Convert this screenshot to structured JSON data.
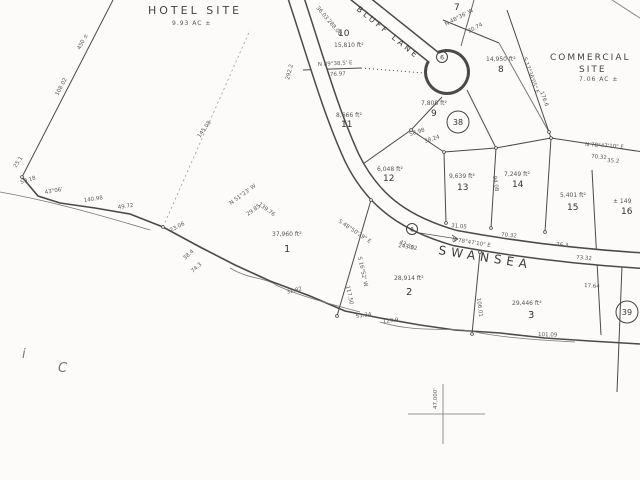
{
  "map": {
    "hotel_site": {
      "name": "HOTEL SITE",
      "acreage": "9.93 AC ±"
    },
    "commercial_site": {
      "line1": "COMMERCIAL",
      "line2": "SITE",
      "acreage": "7.06 AC ±"
    },
    "streets": {
      "swansea": "SWANSEA",
      "bluff_lane": "BLUFF LANE"
    },
    "lots": [
      {
        "number": "1",
        "area": "37,960 ft²"
      },
      {
        "number": "2",
        "area": "28,914 ft²"
      },
      {
        "number": "3",
        "area": "29,446 ft²"
      },
      {
        "number": "7",
        "area": ""
      },
      {
        "number": "8",
        "area": "14,950 ft²"
      },
      {
        "number": "9",
        "area": "7,808 ft²"
      },
      {
        "number": "10",
        "area": "15,810 ft²"
      },
      {
        "number": "11",
        "area": "8,666 ft²"
      },
      {
        "number": "12",
        "area": "6,048 ft²"
      },
      {
        "number": "13",
        "area": "9,639 ft²"
      },
      {
        "number": "14",
        "area": "7,249 ft²"
      },
      {
        "number": "15",
        "area": "5,401 ft²"
      },
      {
        "number": "16",
        "area": "± 149"
      }
    ],
    "curve_markers": {
      "c38": "38",
      "c39": "39",
      "c6a": "6",
      "c6b": "6"
    },
    "grid_label": "47,000'",
    "corner_marks": {
      "m1": "i",
      "m2": "C"
    },
    "dims": [
      "292.2",
      "36.03",
      "288.06",
      "N 89°38.5' E",
      "76.97",
      "S 17°36'05\" E",
      "176.6",
      "N 48°36' W",
      "30.74",
      "58.98",
      "38.24",
      "94.08",
      "N 78°47'10\" E",
      "70.32",
      "35.2",
      "31.05",
      "70.32",
      "76.3",
      "N 78°47'10\" E",
      "243.52",
      "73.32",
      "17.64",
      "139.76",
      "S 48°50'29\" E",
      "42.50",
      "S 16°52' W",
      "117.50",
      "106.01",
      "N 51°23' W",
      "29.85",
      "145.08",
      "25.1",
      "59.18",
      "43°06'",
      "140.98",
      "49.72",
      "23.06",
      "38.4",
      "74.3",
      "31.82",
      "51.34",
      "129.9",
      "101.09",
      "450 ±",
      "108.02"
    ]
  }
}
